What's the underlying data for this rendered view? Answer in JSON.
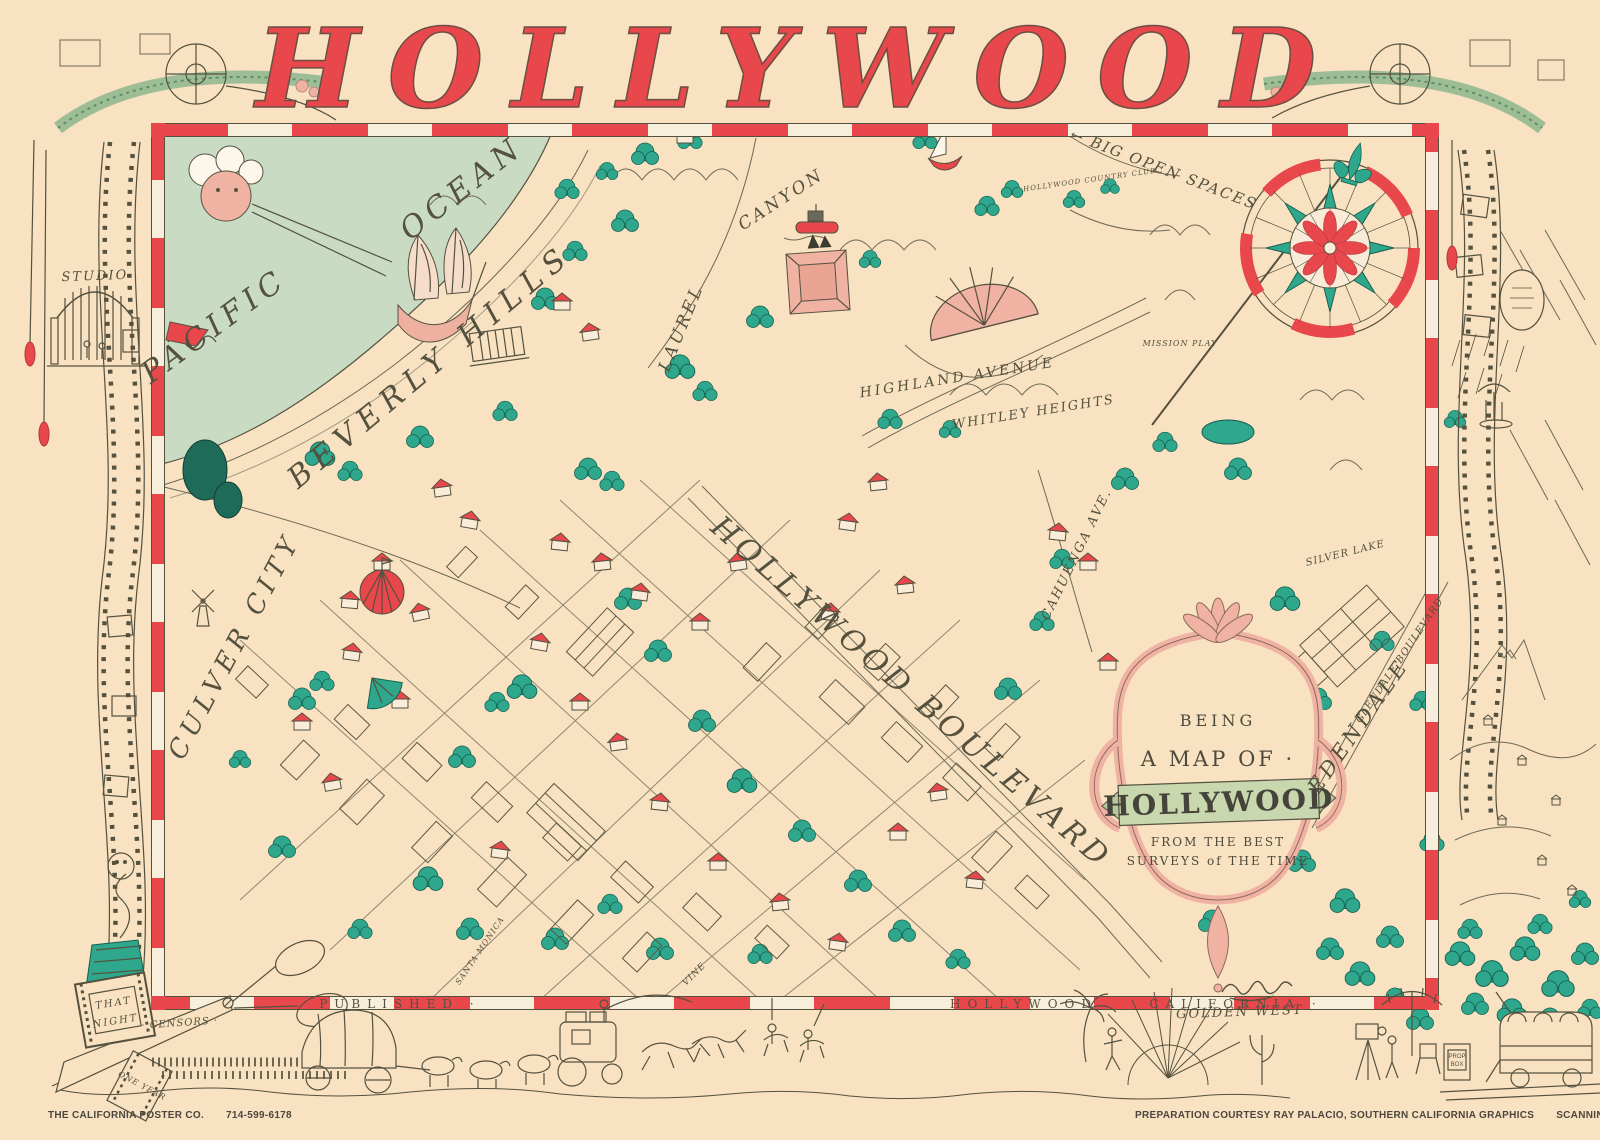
{
  "title": "HOLLYWOOD",
  "colors": {
    "paper": "#f8e2c1",
    "red": "#e8474b",
    "teal": "#2fa78c",
    "ocean": "#c9dcc3",
    "pink": "#f0b2a3",
    "banner_green": "#c9d7ae",
    "ink": "#55513f"
  },
  "cartouche": {
    "line1": "BEING",
    "line2": "A MAP OF ·",
    "line3": "HOLLYWOOD",
    "line4": "FROM THE BEST",
    "line5": "SURVEYS of THE TIME"
  },
  "credits": {
    "publisher": "THE CALIFORNIA POSTER CO.",
    "phone": "714-599-6178",
    "preparation": "PREPARATION COURTESY RAY PALACIO, SOUTHERN CALIFORNIA GRAPHICS",
    "scanning": "SCANNINGS COURTESY HEINZ-WEBER"
  },
  "map": {
    "labels": [
      {
        "name": "pacific-label",
        "text": "PACIFIC",
        "x": 220,
        "y": 334,
        "rot": -36,
        "size": 30,
        "ls": 6
      },
      {
        "name": "ocean-label",
        "text": "OCEAN",
        "x": 468,
        "y": 196,
        "rot": -38,
        "size": 30,
        "ls": 6
      },
      {
        "name": "beverly-hills-label",
        "text": "BEVERLY HILLS",
        "x": 436,
        "y": 374,
        "rot": -40,
        "size": 30,
        "ls": 8
      },
      {
        "name": "hollywood-boulevard-label",
        "text": "HOLLYWOOD BOULEVARD",
        "x": 905,
        "y": 700,
        "rot": 41,
        "size": 30,
        "ls": 5
      },
      {
        "name": "culver-city-label",
        "text": "CULVER CITY",
        "x": 242,
        "y": 650,
        "rot": -62,
        "size": 26,
        "ls": 6
      },
      {
        "name": "laurel-label",
        "text": "LAUREL",
        "x": 686,
        "y": 330,
        "rot": -68,
        "size": 17,
        "ls": 3
      },
      {
        "name": "canyon-label",
        "text": "CANYON",
        "x": 784,
        "y": 204,
        "rot": -33,
        "size": 17,
        "ls": 3
      },
      {
        "name": "highland-avenue-label",
        "text": "HIGHLAND AVENUE",
        "x": 958,
        "y": 382,
        "rot": -9,
        "size": 14,
        "ls": 3
      },
      {
        "name": "whitley-heights-label",
        "text": "WHITLEY HEIGHTS",
        "x": 1034,
        "y": 416,
        "rot": -9,
        "size": 13,
        "ls": 2
      },
      {
        "name": "cahuenga-avenue-label",
        "text": "CAHUENGA AVE.",
        "x": 1080,
        "y": 556,
        "rot": -64,
        "size": 13,
        "ls": 2
      },
      {
        "name": "big-open-spaces-label",
        "text": "← BIG OPEN SPACES",
        "x": 1162,
        "y": 174,
        "rot": 21,
        "size": 15,
        "ls": 2
      },
      {
        "name": "edendale-label",
        "text": "EDENDALE",
        "x": 1364,
        "y": 730,
        "rot": -55,
        "size": 21,
        "ls": 4
      },
      {
        "name": "glendale-boulevard-label",
        "text": "GLENDALE BOULEVARD",
        "x": 1402,
        "y": 662,
        "rot": -56,
        "size": 10,
        "ls": 1
      },
      {
        "name": "silver-lake-label",
        "text": "SILVER LAKE",
        "x": 1346,
        "y": 556,
        "rot": -14,
        "size": 10,
        "ls": 1
      },
      {
        "name": "studio-gate-label",
        "text": "STUDIO",
        "x": 95,
        "y": 280,
        "rot": -2,
        "size": 13,
        "ls": 2
      },
      {
        "name": "golden-west-label",
        "text": "GOLDEN WEST",
        "x": 1240,
        "y": 1016,
        "rot": -2,
        "size": 13,
        "ls": 2
      },
      {
        "name": "border-published-label",
        "text": "PUBLISHED ·",
        "x": 400,
        "y": 1008,
        "rot": 0,
        "size": 12,
        "ls": 7,
        "italic": false
      },
      {
        "name": "border-hollywood-label",
        "text": "HOLLYWOOD",
        "x": 1024,
        "y": 1008,
        "rot": 0,
        "size": 12,
        "ls": 7,
        "italic": false
      },
      {
        "name": "border-california-label",
        "text": "CALIFORNIA ·",
        "x": 1236,
        "y": 1008,
        "rot": 0,
        "size": 12,
        "ls": 7,
        "italic": false
      },
      {
        "name": "mission-play-label",
        "text": "MISSION PLAY",
        "x": 1180,
        "y": 346,
        "rot": 0,
        "size": 8,
        "ls": 1
      },
      {
        "name": "country-club-label",
        "text": "HOLLYWOOD COUNTRY CLUB",
        "x": 1090,
        "y": 182,
        "rot": -8,
        "size": 7,
        "ls": 1
      },
      {
        "name": "that-night-label-top",
        "text": "THAT",
        "x": 114,
        "y": 1006,
        "rot": -9,
        "size": 10,
        "ls": 2
      },
      {
        "name": "that-night-label-bottom",
        "text": "NIGHT",
        "x": 116,
        "y": 1024,
        "rot": -9,
        "size": 10,
        "ls": 2
      },
      {
        "name": "censors-label",
        "text": "· CENSORS ·",
        "x": 180,
        "y": 1026,
        "rot": -4,
        "size": 10,
        "ls": 1
      },
      {
        "name": "one-year-label",
        "text": "ONE YEAR",
        "x": 141,
        "y": 1088,
        "rot": 28,
        "size": 8,
        "ls": 1
      },
      {
        "name": "prop-box-label-top",
        "text": "PROP",
        "x": 1457,
        "y": 1058,
        "rot": 0,
        "size": 6,
        "ls": 0,
        "italic": false,
        "sans": true
      },
      {
        "name": "prop-box-label-bottom",
        "text": "BOX",
        "x": 1457,
        "y": 1066,
        "rot": 0,
        "size": 6,
        "ls": 0,
        "italic": false,
        "sans": true
      },
      {
        "name": "vine-street-label",
        "text": "VINE",
        "x": 696,
        "y": 976,
        "rot": -45,
        "size": 9,
        "ls": 1
      },
      {
        "name": "santa-monica-label",
        "text": "SANTA MONICA",
        "x": 482,
        "y": 952,
        "rot": -56,
        "size": 8,
        "ls": 1
      }
    ]
  }
}
